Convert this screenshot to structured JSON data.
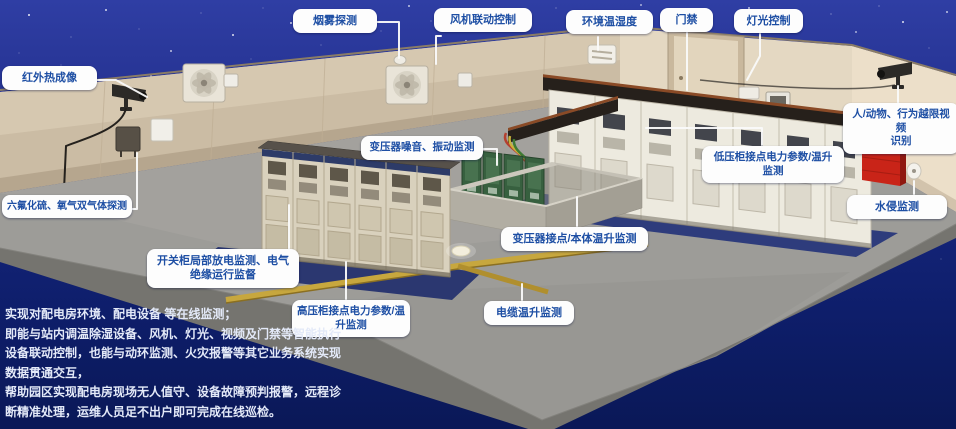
{
  "callouts": {
    "infrared": {
      "label": "红外热成像"
    },
    "smoke": {
      "label": "烟雾探测"
    },
    "fan_control": {
      "label": "风机联动控制"
    },
    "env_temp_humidity": {
      "label": "环境温湿度"
    },
    "door_access": {
      "label": "门禁"
    },
    "light_control": {
      "label": "灯光控制"
    },
    "video_recognition": {
      "label": "人/动物、行为越限视频\n识别"
    },
    "gas_detection": {
      "label": "六氟化硫、氧气双气体探测"
    },
    "water_intrusion": {
      "label": "水侵监测"
    },
    "transformer_noise": {
      "label": "变压器噪音、振动监测"
    },
    "lv_cabinet": {
      "label": "低压柜接点电力参数/温升\n监测"
    },
    "partial_discharge": {
      "label": "开关柜局部放电监测、电气\n绝缘运行监督"
    },
    "transformer_contact": {
      "label": "变压器接点/本体温升监测"
    },
    "hv_cabinet": {
      "label": "高压柜接点电力参数/温\n升监测"
    },
    "cable_temp": {
      "label": "电缆温升监测"
    }
  },
  "description": {
    "lines": [
      "实现对配电房环境、配电设备 等在线监测；",
      "即能与站内调温除湿设备、风机、灯光、视频及门禁等智能执行",
      "设备联动控制，也能与动环监测、火灾报警等其它业务系统实现",
      "数据贯通交互，",
      "帮助园区实现配电房现场无人值守、设备故障预判报警，远程诊",
      "断精准处理，运维人员足不出户即可完成在线巡检。"
    ]
  },
  "colors": {
    "sky_blue": "#2f3ea4",
    "deep_blue": "#0a1857",
    "callout_text": "#1e4fa4",
    "wall_beige": "#d4c6ae",
    "floor_gray": "#9d9c98",
    "alarm_red": "#c92418"
  }
}
